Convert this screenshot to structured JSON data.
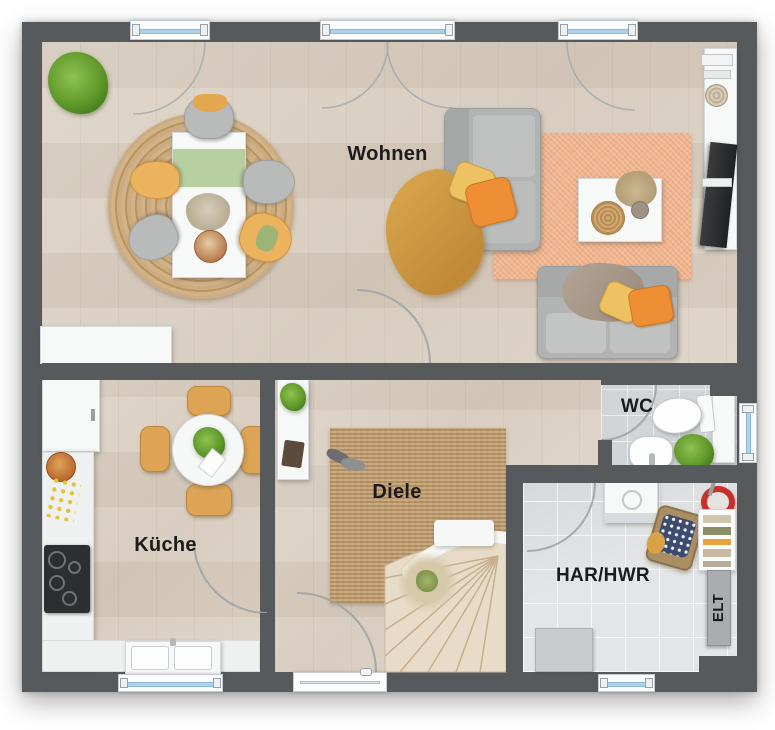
{
  "image_type": "architectural floor plan, top-down 3D render, ground floor",
  "rooms": {
    "wohnen": {
      "label": "Wohnen"
    },
    "kueche": {
      "label": "Küche"
    },
    "diele": {
      "label": "Diele"
    },
    "wc": {
      "label": "WC"
    },
    "har": {
      "label": "HAR/HWR"
    },
    "elt": {
      "label": "ELT"
    }
  },
  "palette": {
    "wall": "#565a5d",
    "wood_floor": "#dbd1c5",
    "tile_wc": "#d2d5d7",
    "tile_har": "#e3e5e6",
    "rug_jute": "#c5a274",
    "rug_peach": "#efb28b",
    "sofa_gray": "#b2b4b3",
    "accent_yellow": "#ecb35e",
    "accent_orange": "#ef8f35",
    "throw_mustard": "#d9a24b",
    "runner_green": "#b7cfa0",
    "plant_green": "#5d9628",
    "bucket_red": "#c8302b",
    "window_glass": "#aed2ea",
    "label_text": "#1b1b1b"
  }
}
